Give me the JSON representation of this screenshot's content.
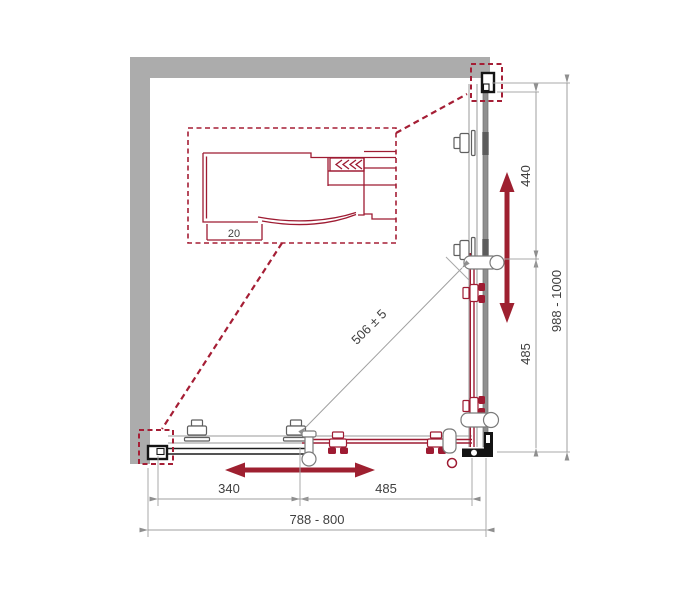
{
  "diagram": {
    "title": "corner-shower-enclosure-top-view-dimension-drawing",
    "labels": {
      "detail_dim": "20",
      "bottom_fixed_dim": "340",
      "bottom_door_dim": "485",
      "bottom_total_dim": "788 - 800",
      "right_fixed_dim": "440",
      "right_door_dim": "485",
      "right_total_dim": "988 - 1000",
      "diagonal_dim": "506 ± 5"
    },
    "colors": {
      "accent_red": "#9E1B32",
      "wall_gray": "#ACACAC",
      "glass_gray": "#8f8f8f",
      "dimension_gray": "#9f9f9f",
      "text_gray": "#3f3f3f",
      "bracket_black": "#141414"
    }
  }
}
